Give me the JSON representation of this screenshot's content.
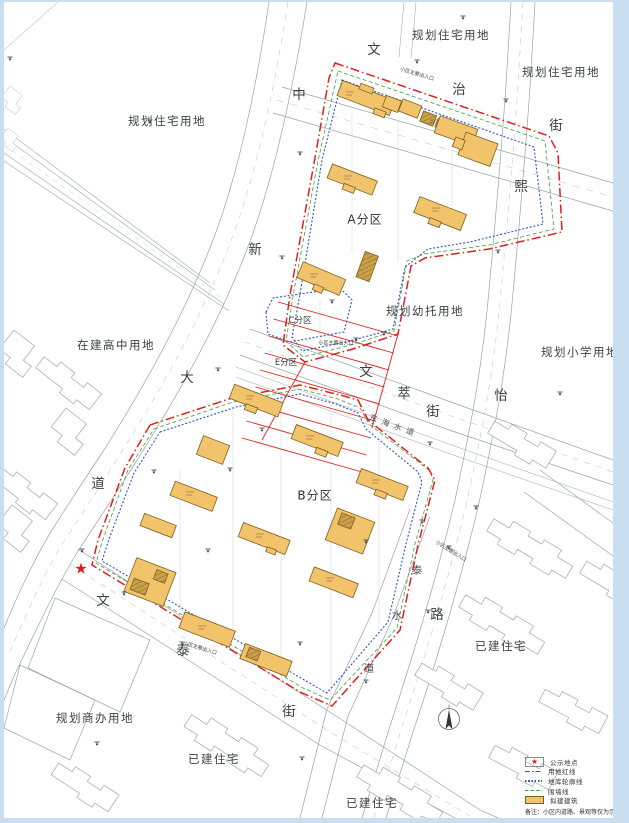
{
  "labels": {
    "landuse": [
      "规划住宅用地",
      "规划住宅用地",
      "规划住宅用地",
      "在建高中用地",
      "规划幼托用地",
      "规划小学用地",
      "规划商办用地",
      "已建住宅",
      "已建住宅",
      "已建住宅"
    ],
    "zones": [
      "A分区",
      "B分区",
      "C分区",
      "E分区"
    ],
    "entrance": "小区主要出入口"
  },
  "streets": {
    "wenzhi": [
      "文",
      "治",
      "街"
    ],
    "xiyi": [
      "熙",
      "怡",
      "路"
    ],
    "zhongxin": [
      "中",
      "新",
      "大",
      "道"
    ],
    "wencui": [
      "文",
      "萃",
      "街"
    ],
    "wentai": [
      "文",
      "泰",
      "街"
    ],
    "taishui": [
      "泰",
      "水",
      "道"
    ],
    "canal": "东海水道"
  },
  "legend": {
    "items": [
      "公示地点",
      "用地红线",
      "地库轮廓线",
      "围墙线",
      "拟建建筑"
    ],
    "note": "备注：小区内道路、景观等仅为示意方案。"
  },
  "icons": {
    "star": "★"
  },
  "colors": {
    "boundary_red": "#e0201c",
    "garage_blue": "#2e55c2",
    "fence_green": "#3fa03f",
    "building_fill": "#f1c46b",
    "building_dark": "#c9a04a",
    "road_gray": "#9aa2a8",
    "margin_blue": "#c9def0"
  }
}
